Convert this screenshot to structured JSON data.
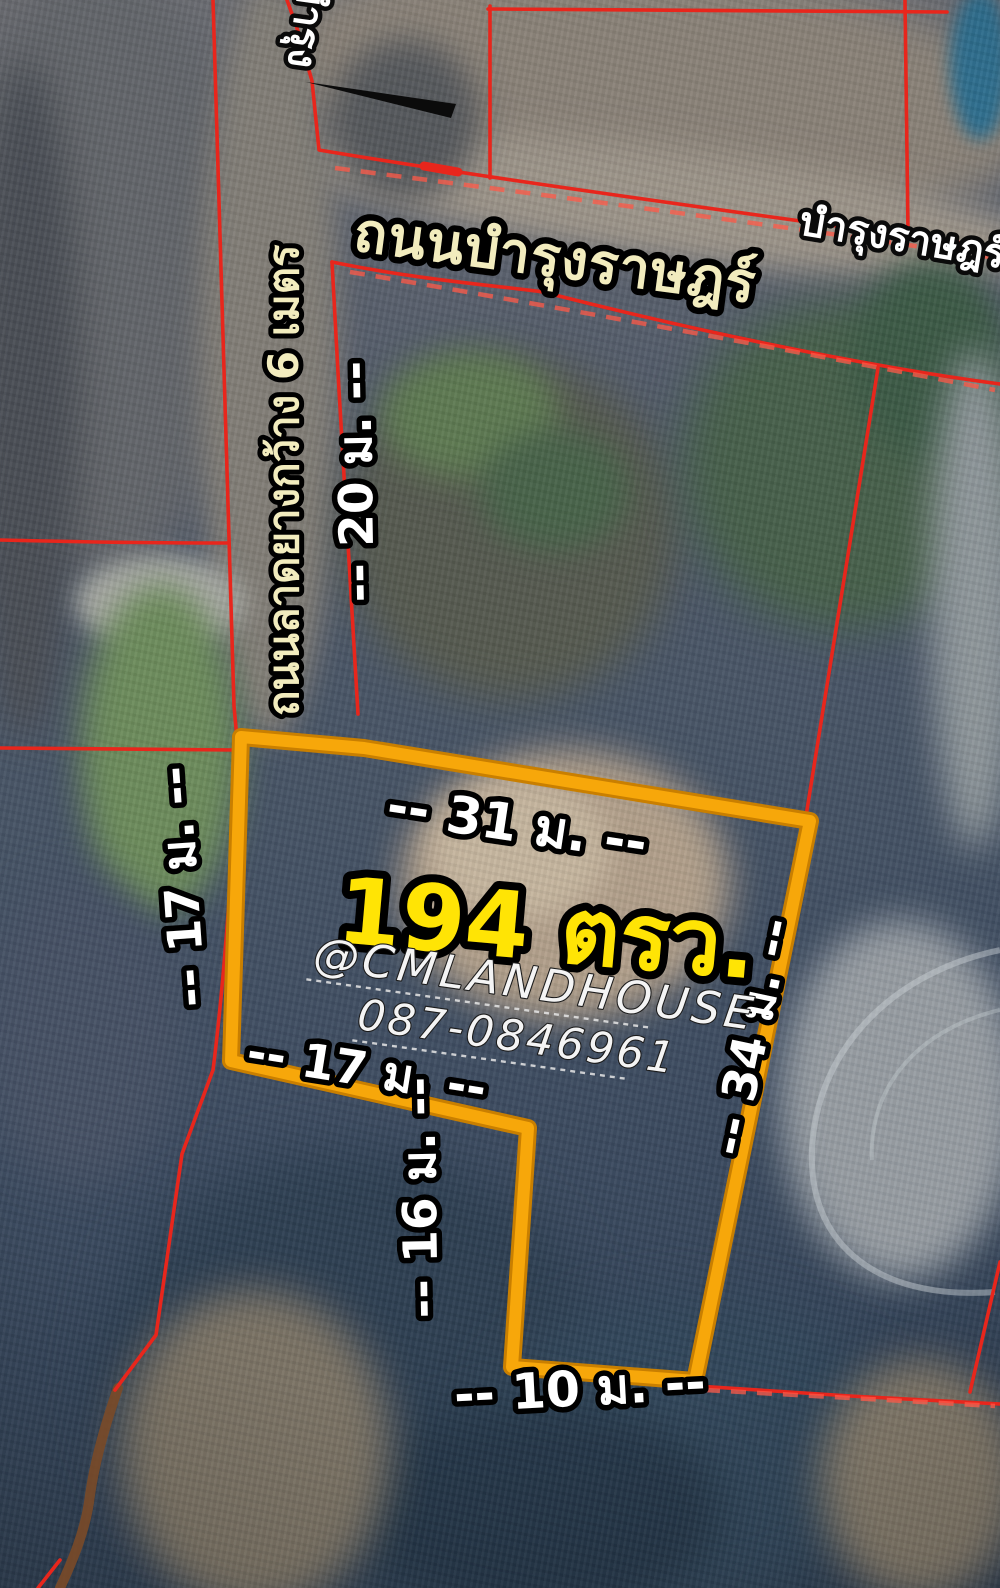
{
  "title": "Land plot satellite listing map",
  "colors": {
    "boundary_red": "#e8261c",
    "boundary_red_light": "#ff5a48",
    "plot_outline": "#f7a70a",
    "plot_outline_dark": "#c97f00",
    "road_label_fill": "#f2ecbe",
    "measure_fill": "#ffffff",
    "area_fill": "#ffe405",
    "contact_fill": "#f4f4f4"
  },
  "map": {
    "road_label_top": "ถนนบำรุงราษฎร์",
    "road_label_right_partial": "บำรุงราษฎร์",
    "road_label_topleft_partial": "บำรุง",
    "side_road_label": "ถนนลาดยางกว้าง 6 เมตร",
    "plot": {
      "area_label": "194 ตรว.",
      "contact_handle": "@CMLANDHOUSE",
      "contact_phone": "087-0846961"
    },
    "measurements": {
      "top_edge": "-- 31 ม. --",
      "left_edge": "-- 17 ม. --",
      "road_depth": "-- 20 ม. --",
      "step_edge": "-- 17 ม. --",
      "lower_left_edge": "-- 16 ม. --",
      "right_edge": "-- 34 ม. --",
      "bottom_edge": "-- 10 ม. --"
    }
  }
}
